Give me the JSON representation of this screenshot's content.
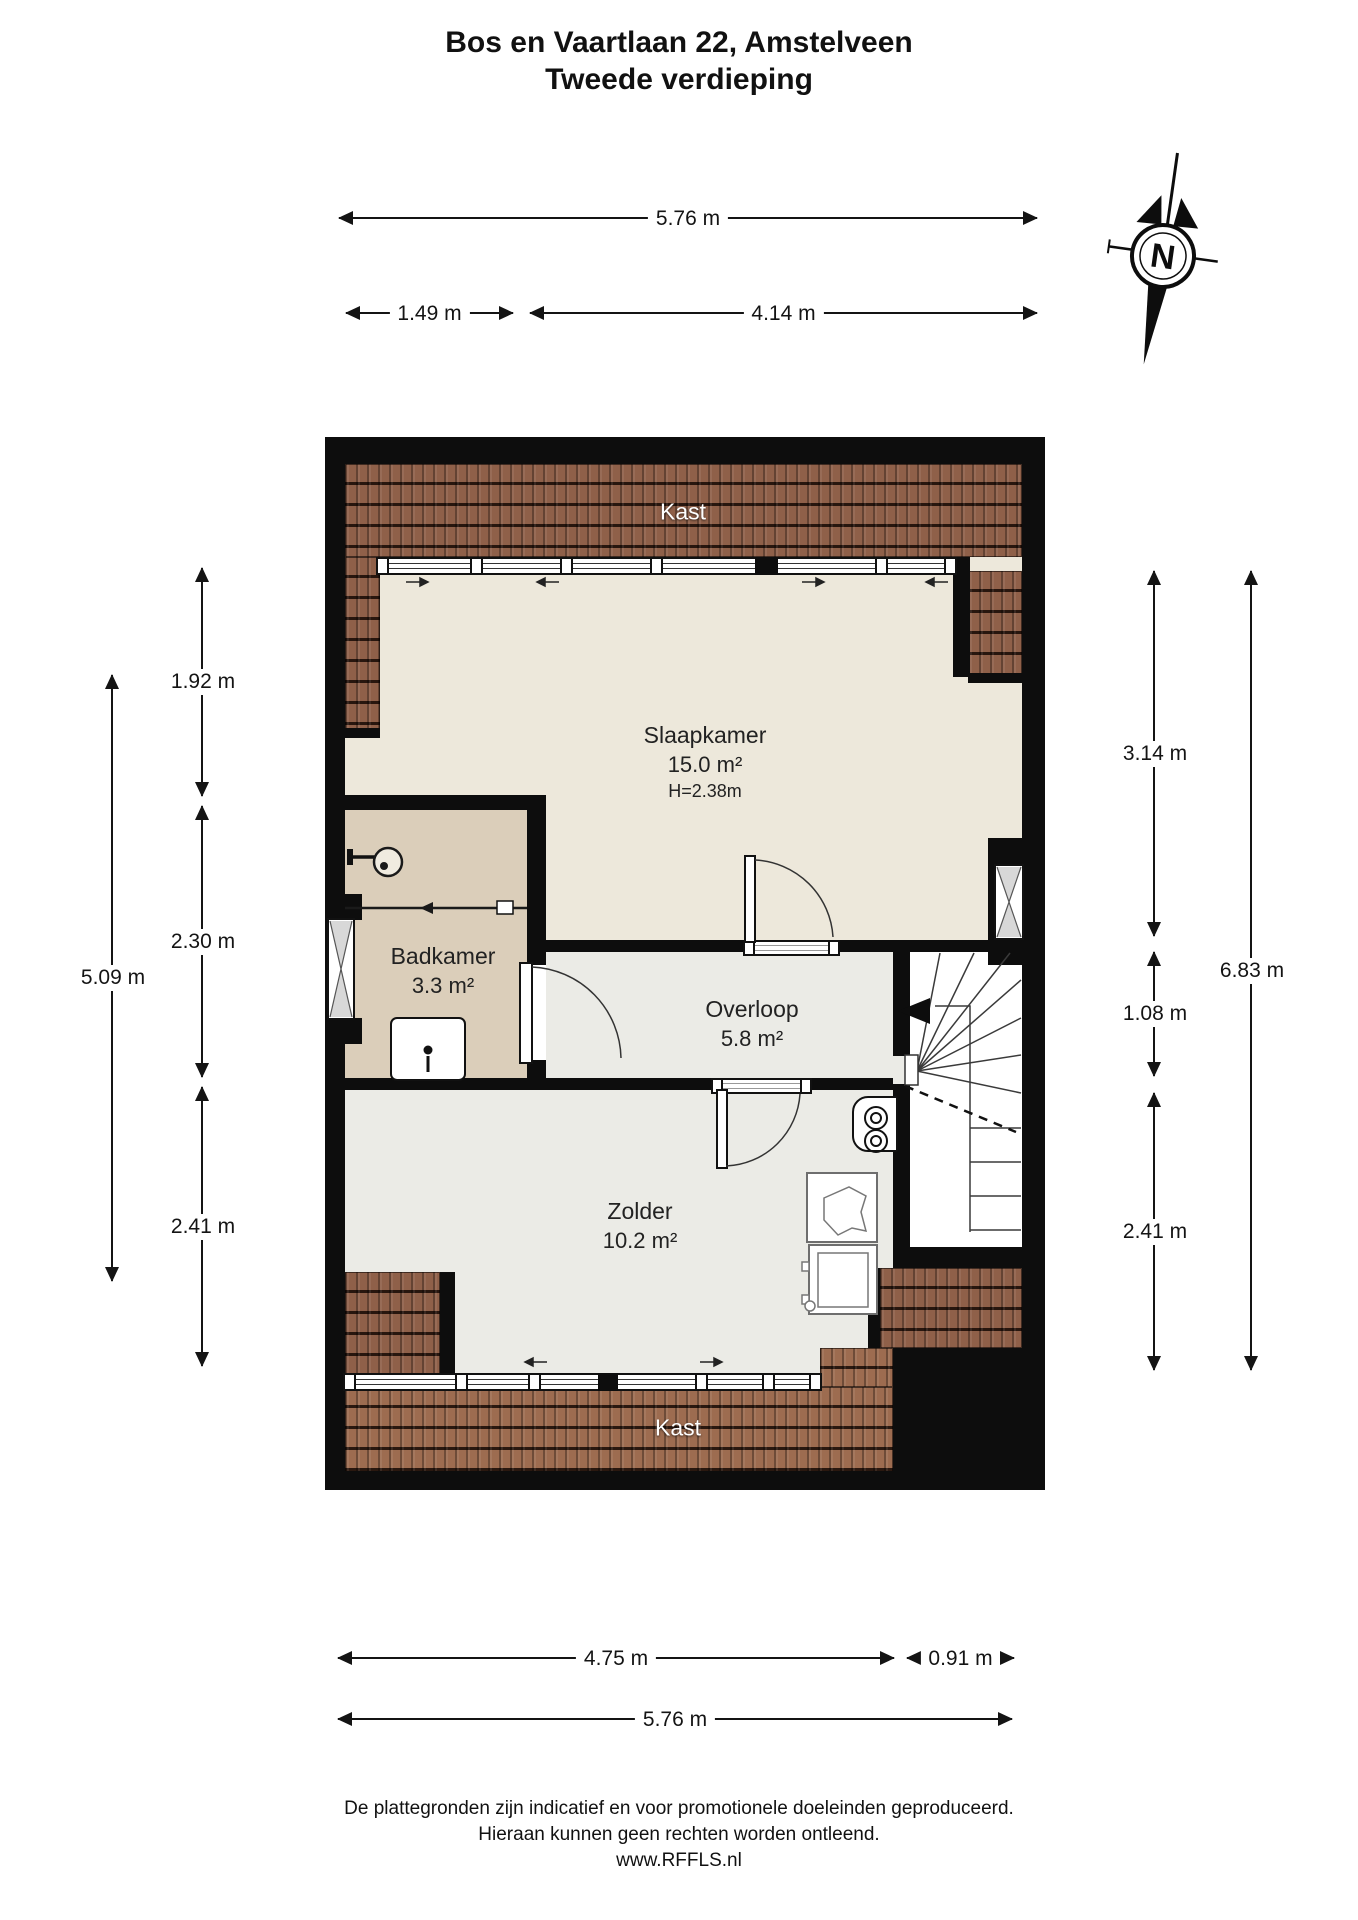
{
  "title": {
    "line1": "Bos en Vaartlaan 22, Amstelveen",
    "line2": "Tweede verdieping"
  },
  "compass": {
    "label": "N"
  },
  "rooms": {
    "kast_top": {
      "name": "Kast"
    },
    "slaapkamer": {
      "name": "Slaapkamer",
      "area": "15.0 m²",
      "ceiling": "H=2.38m"
    },
    "badkamer": {
      "name": "Badkamer",
      "area": "3.3 m²"
    },
    "overloop": {
      "name": "Overloop",
      "area": "5.8 m²"
    },
    "zolder": {
      "name": "Zolder",
      "area": "10.2 m²"
    },
    "kast_bottom": {
      "name": "Kast"
    }
  },
  "dimensions": {
    "top": {
      "total": "5.76 m",
      "left": "1.49 m",
      "right": "4.14 m"
    },
    "left": {
      "outer": "5.09 m",
      "seg1": "1.92 m",
      "seg2": "2.30 m",
      "seg3": "2.41 m"
    },
    "right": {
      "seg1": "3.14 m",
      "seg2": "1.08 m",
      "seg3": "2.41 m",
      "outer": "6.83 m"
    },
    "bottom": {
      "left": "4.75 m",
      "right": "0.91 m",
      "total": "5.76 m"
    }
  },
  "footer": {
    "line1": "De plattegronden zijn indicatief en voor promotionele doeleinden geproduceerd.",
    "line2": "Hieraan kunnen geen rechten worden ontleend.",
    "line3": "www.RFFLS.nl"
  },
  "colors": {
    "wall": "#0d0d0d",
    "floor_bedroom": "#EDE8DB",
    "floor_landing": "#EBEBE6",
    "floor_bathroom": "#DBCEBA",
    "roof_tiles": "#8F6049",
    "roof_tiles_light": "#9D6C50"
  }
}
